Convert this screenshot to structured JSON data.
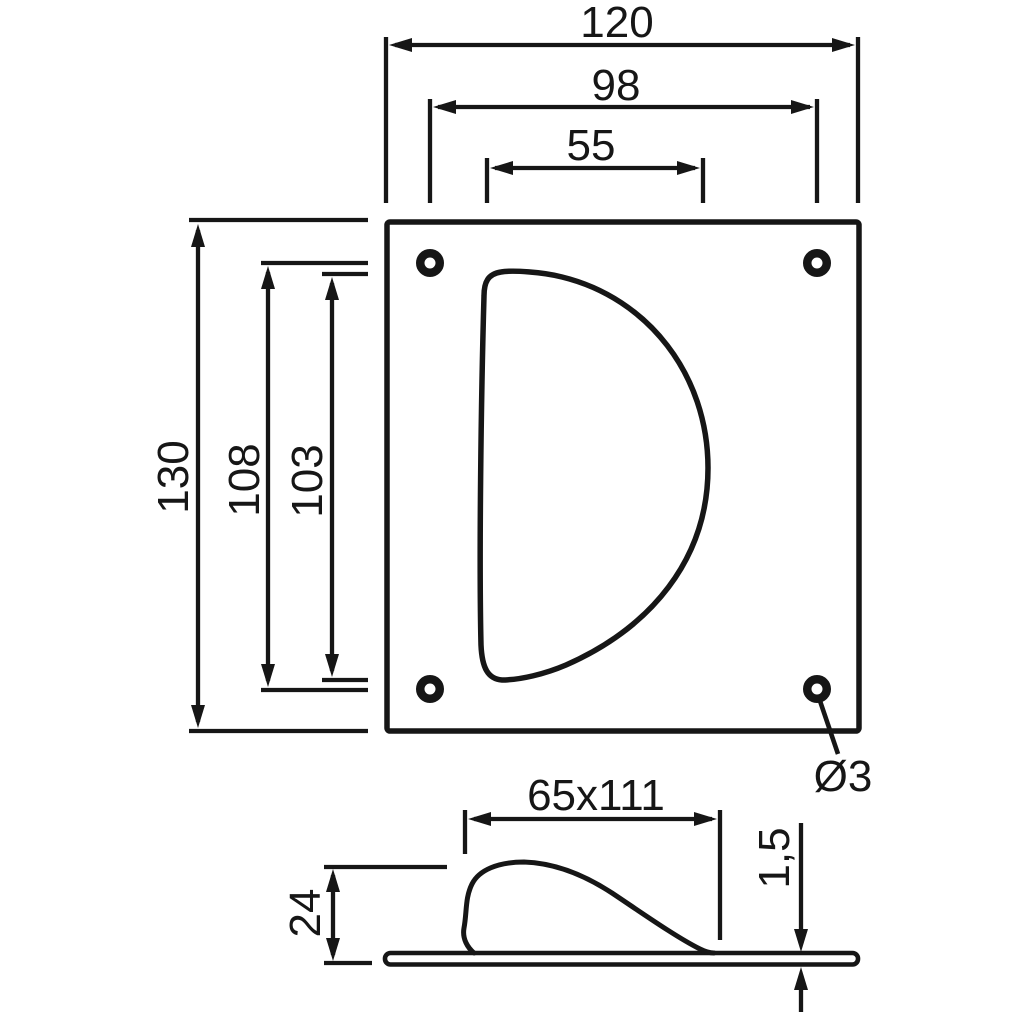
{
  "diagram": {
    "colors": {
      "line": "#161616",
      "background": "#ffffff"
    },
    "front_view": {
      "plate_width": "120",
      "hole_spacing_width": "98",
      "cutout_top_width": "55",
      "plate_height": "130",
      "hole_spacing_height": "108",
      "cutout_height": "103",
      "hole_diameter": "Ø3"
    },
    "side_view": {
      "recess_size": "65x111",
      "recess_depth": "24",
      "plate_thickness": "1,5"
    }
  }
}
